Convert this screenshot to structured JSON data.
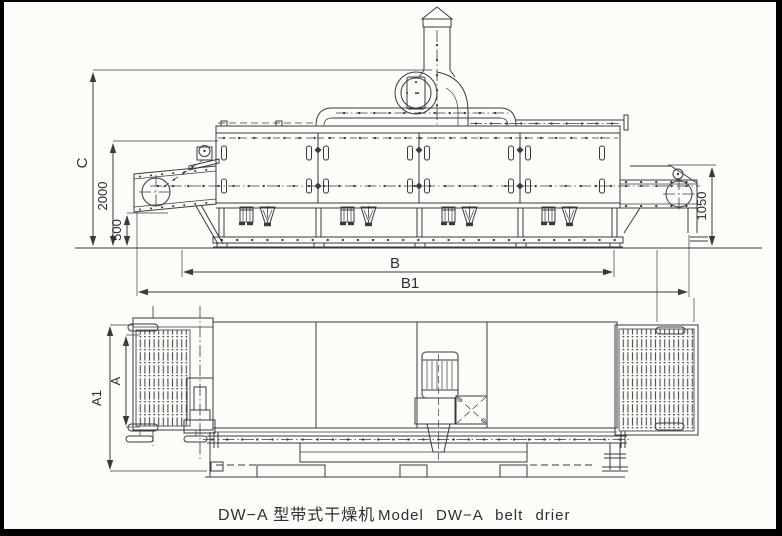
{
  "caption": {
    "title_cn": "DW−A 型带式干燥机",
    "title_en": "Model DW−A belt drier"
  },
  "dimensions": {
    "total_height": "C",
    "feed_conveyor_height": "2000",
    "clearance_height": "500",
    "body_length": "B",
    "overall_length": "B1",
    "discharge_height": "1050",
    "belt_width": "A",
    "overall_width": "A1"
  },
  "colors": {
    "ink": "#3a3a3a",
    "paper": "#fcfcf9",
    "border": "#000000"
  }
}
